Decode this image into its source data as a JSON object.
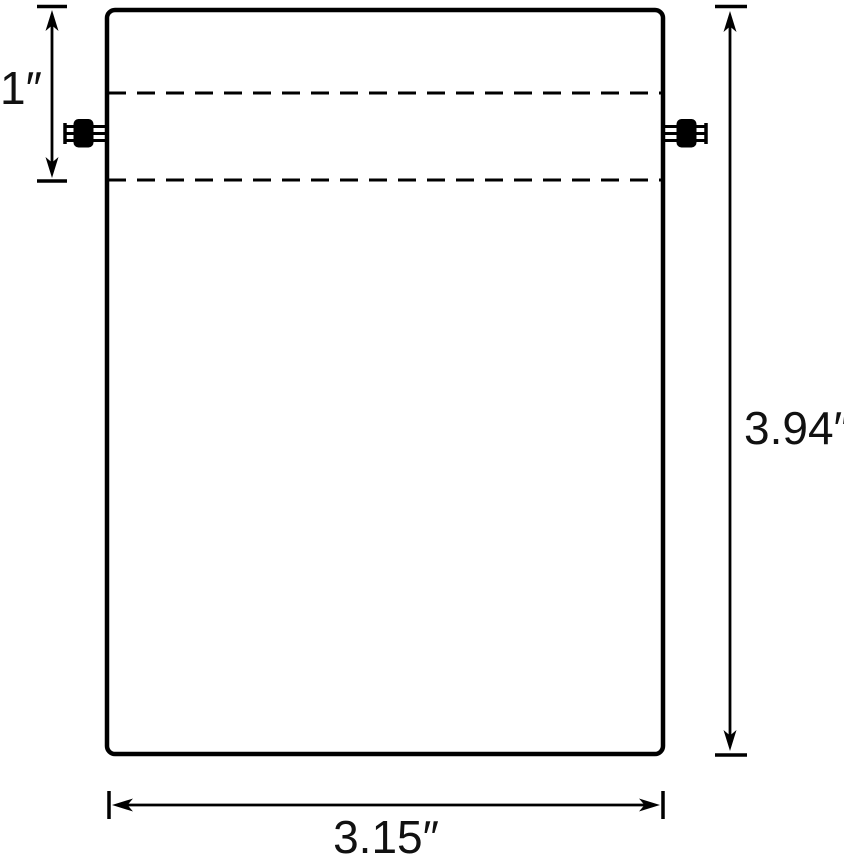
{
  "diagram": {
    "type": "product-dimension-diagram",
    "subject": "drawstring bag outline with cord locks",
    "measurements": {
      "hem_height": {
        "label": "1″"
      },
      "bag_height": {
        "label": "3.94″"
      },
      "bag_width": {
        "label": "3.15″"
      }
    },
    "colors": {
      "ink": "#000000",
      "label_text": "#111111",
      "background": "#ffffff"
    },
    "icons": [
      "cord-lock-left-icon",
      "cord-lock-right-icon"
    ]
  }
}
